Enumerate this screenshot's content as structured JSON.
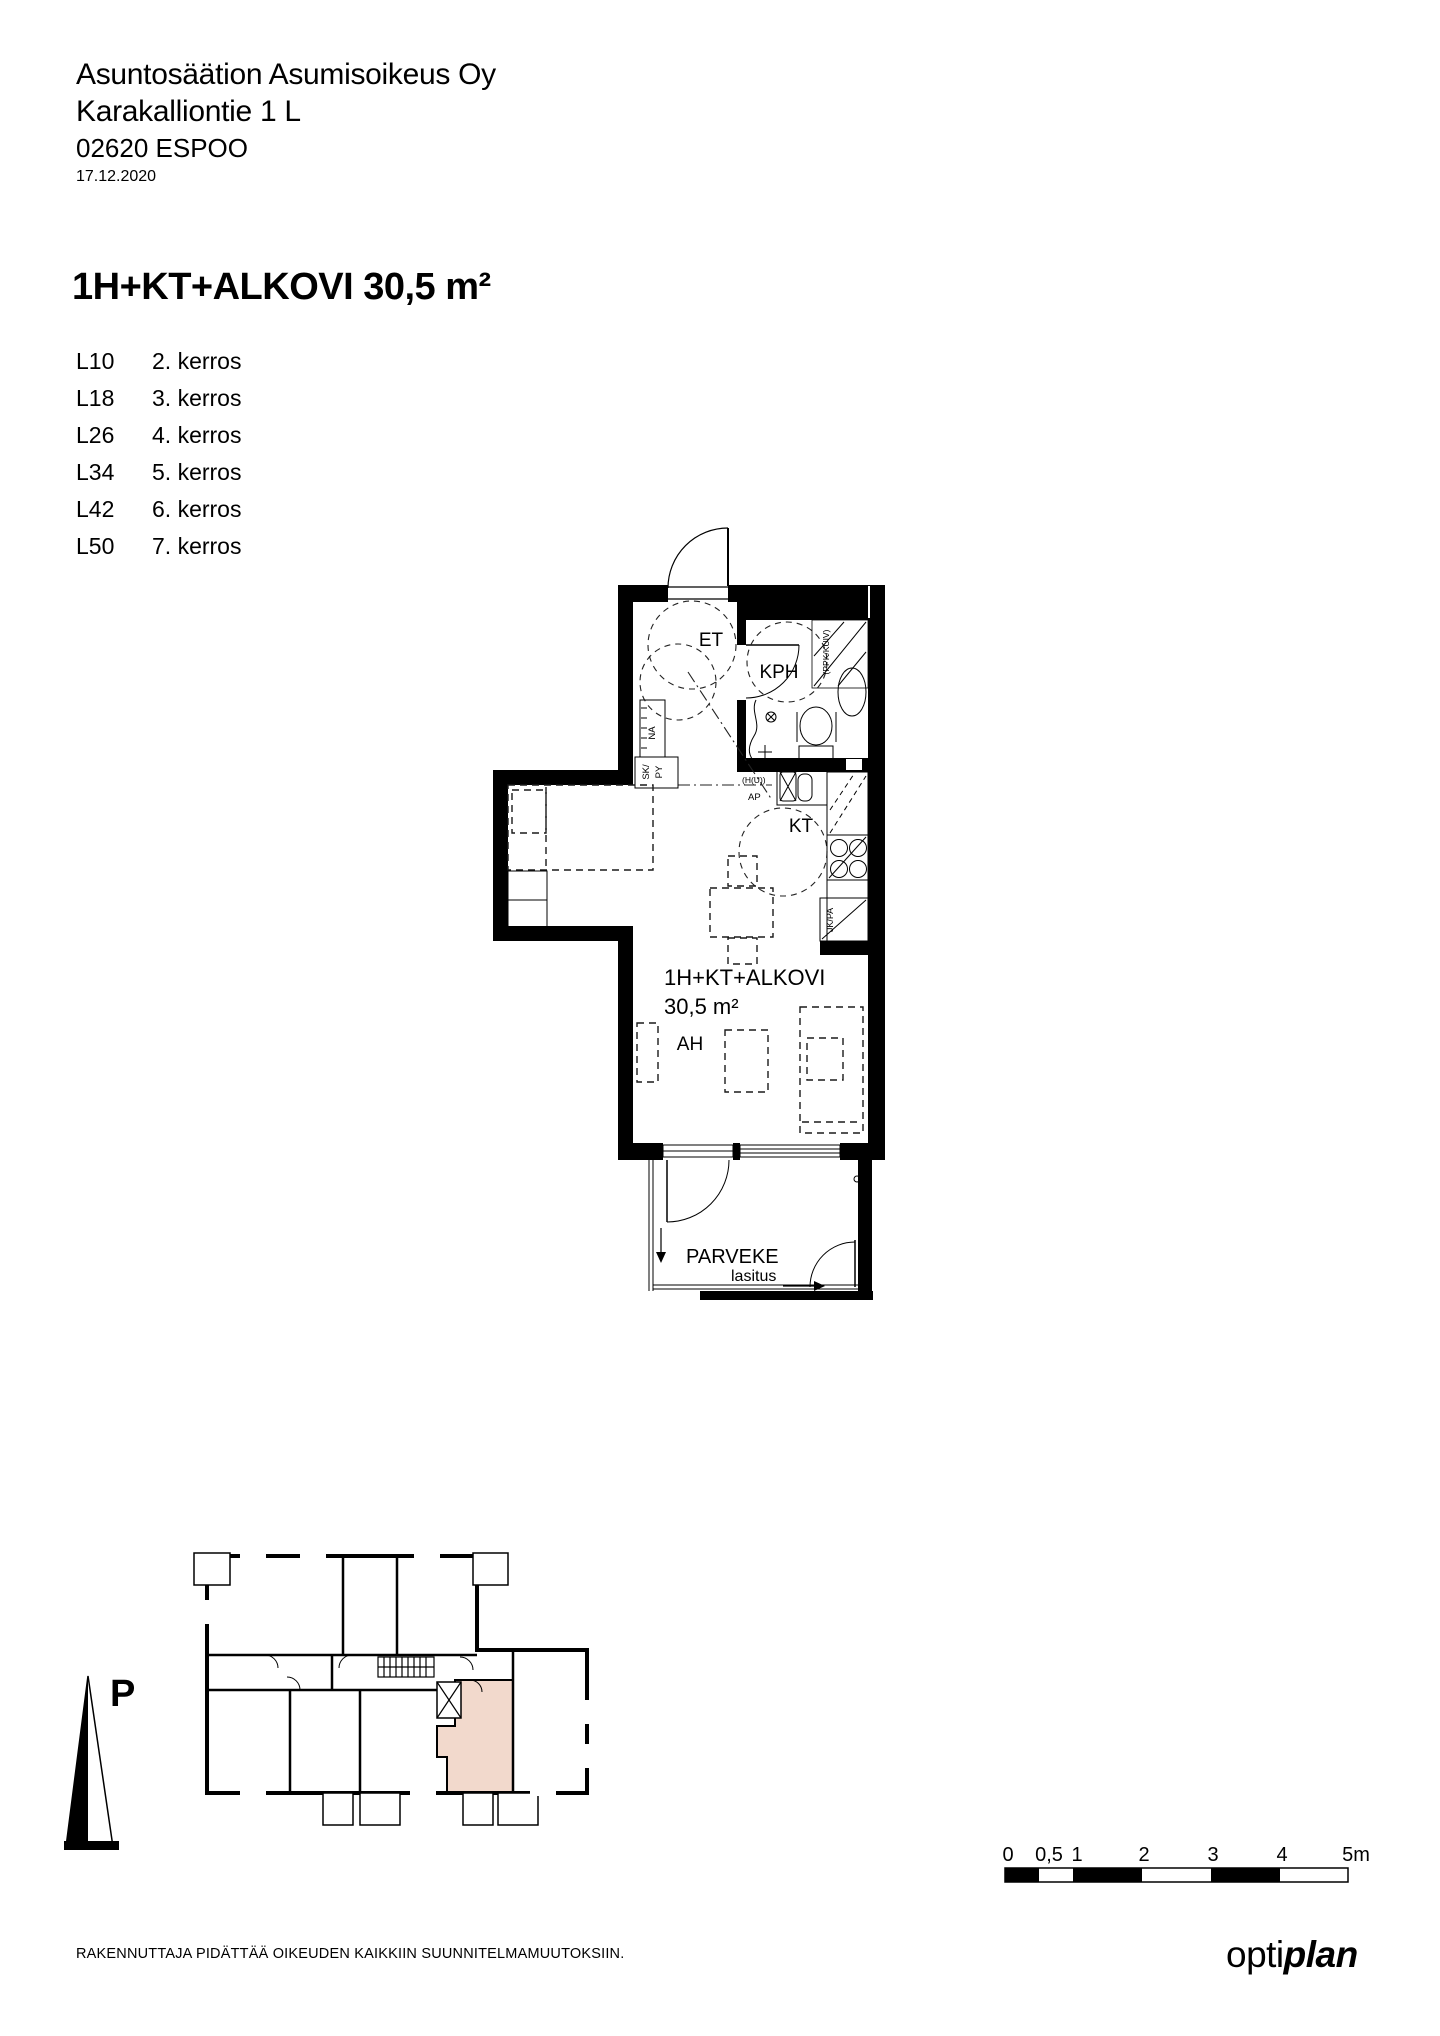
{
  "document": {
    "company": "Asuntosäätion Asumisoikeus Oy",
    "street": "Karakalliontie 1 L",
    "city": "02620 ESPOO",
    "date": "17.12.2020",
    "disclaimer": "RAKENNUTTAJA PIDÄTTÄÄ OIKEUDEN KAIKKIIN SUUNNITELMAMUUTOKSIIN.",
    "logo": {
      "regular": "opti",
      "bold": "plan"
    }
  },
  "apartment": {
    "type_title": "1H+KT+ALKOVI 30,5 m²",
    "units": [
      {
        "code": "L10",
        "floor": "2. kerros"
      },
      {
        "code": "L18",
        "floor": "3. kerros"
      },
      {
        "code": "L26",
        "floor": "4. kerros"
      },
      {
        "code": "L34",
        "floor": "5. kerros"
      },
      {
        "code": "L42",
        "floor": "6. kerros"
      },
      {
        "code": "L50",
        "floor": "7. kerros"
      }
    ]
  },
  "floorplan": {
    "rooms": {
      "entry": "ET",
      "bathroom": "KPH",
      "kitchen": "KT",
      "living": "AH"
    },
    "area_label": {
      "line1": "1H+KT+ALKOVI",
      "line2": "30,5 m²"
    },
    "balcony": {
      "name": "PARVEKE",
      "glazing": "lasitus"
    },
    "fixtures": {
      "coat_rack": "NA",
      "cleaning_1": "SK/",
      "cleaning_2": "PY",
      "dryer": "(PPK/KUIV)",
      "stove_reservation": "(H(U))",
      "dishwasher": "AP",
      "fridge": "JK/PA"
    }
  },
  "key_plan": {
    "north_label": "P",
    "highlight_color": "#f2d9cc"
  },
  "scale_bar": {
    "labels": [
      "0",
      "0,5",
      "1",
      "2",
      "3",
      "4",
      "5m"
    ]
  }
}
